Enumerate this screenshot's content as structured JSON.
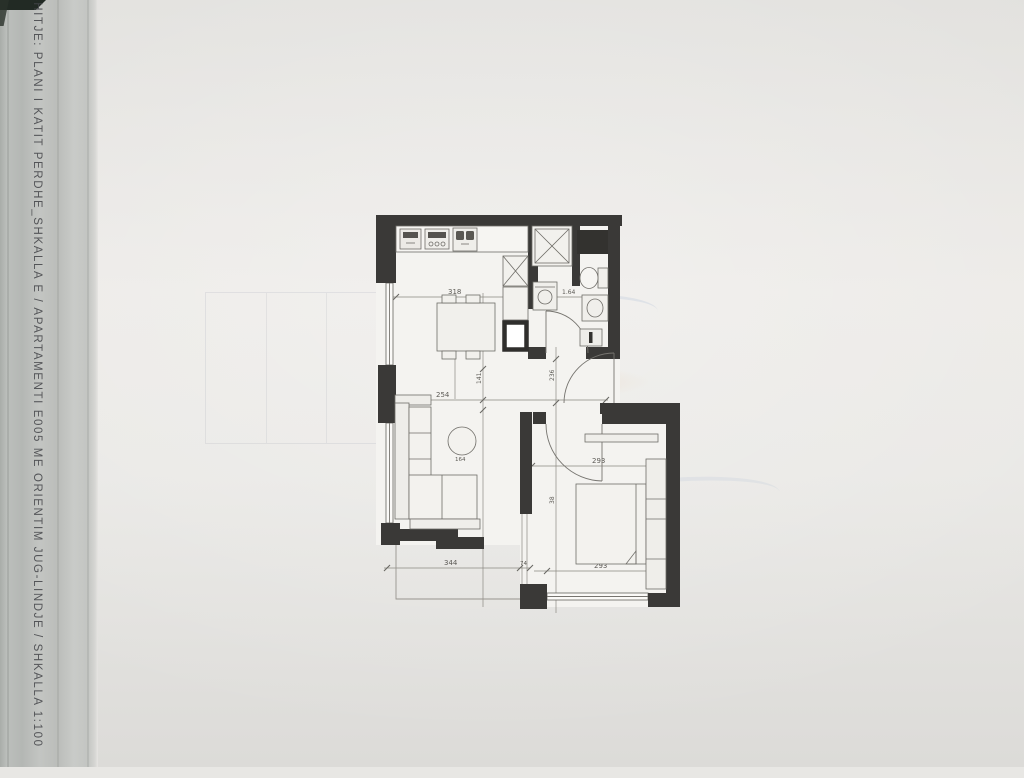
{
  "page": {
    "background_color": "#e8e7e4",
    "edge_strip_color": "#bcbfbc",
    "title_vertical": "SHITJE: PLANI I KATIT PERDHE_SHKALLA E / APARTAMENTI E005 ME ORIENTIM JUG-LINDJE / SHKALLA 1:100"
  },
  "floor_plan": {
    "wall_color": "#3a3937",
    "line_color": "#74726d",
    "room_fill": "#f4f3f0",
    "dimensions": {
      "kitchen_width": "318",
      "bathroom_width": "1.64",
      "living_width": "254",
      "hall_height": "141",
      "hall_height_2": "236",
      "bedroom_width_top": "293",
      "bedroom_side": "38",
      "terrace_width": "344",
      "step_width": "74",
      "bedroom_width_bottom": "293",
      "table_label": "164"
    },
    "fixtures": [
      "fridge-icon",
      "stove-icon",
      "kitchen-sink-icon",
      "dining-table-icon",
      "closet-icon",
      "shaft-icon",
      "shower-icon",
      "duct-icon",
      "toilet-icon",
      "washing-machine-icon",
      "vanity-sink-icon",
      "radiator-icon",
      "sofa-icon",
      "round-table-icon",
      "sideboard-icon",
      "bed-icon",
      "wardrobe-icon",
      "console-icon",
      "entrance-door-arc",
      "bedroom-door-arc",
      "bathroom-door-arc"
    ]
  }
}
